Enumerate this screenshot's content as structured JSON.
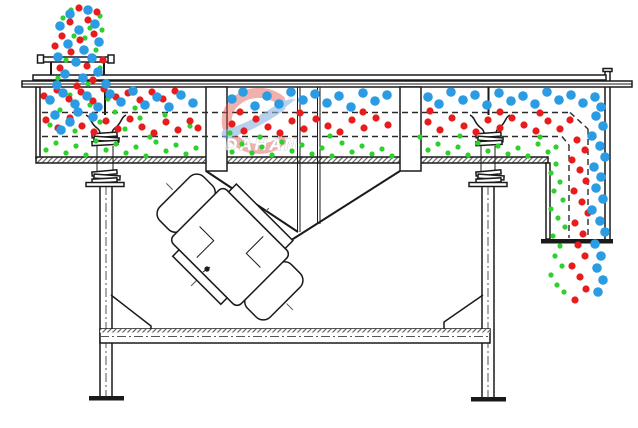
{
  "watermark": {
    "text": "DAHAN",
    "registered": "®",
    "logo_red": "#e2574b",
    "logo_blue": "#8cb4e2",
    "text_color": "#b5b5b5"
  },
  "colors": {
    "coarse_particle_blue": "#2b9be4",
    "medium_particle_red": "#e81c1c",
    "fine_particle_green": "#2ed02e",
    "line_black": "#1a1a1a",
    "background": "#ffffff"
  },
  "particles": {
    "blue": {
      "label": "coarse-particles",
      "color": "#2b9be4",
      "r": 4.8,
      "points": [
        [
          70,
          14
        ],
        [
          88,
          10
        ],
        [
          60,
          26
        ],
        [
          79,
          30
        ],
        [
          95,
          24
        ],
        [
          68,
          44
        ],
        [
          84,
          50
        ],
        [
          99,
          42
        ],
        [
          58,
          57
        ],
        [
          76,
          62
        ],
        [
          92,
          58
        ],
        [
          65,
          74
        ],
        [
          83,
          78
        ],
        [
          98,
          72
        ],
        [
          106,
          84
        ],
        [
          57,
          85
        ],
        [
          50,
          100
        ],
        [
          63,
          93
        ],
        [
          75,
          104
        ],
        [
          87,
          96
        ],
        [
          98,
          107
        ],
        [
          110,
          94
        ],
        [
          121,
          102
        ],
        [
          133,
          91
        ],
        [
          145,
          105
        ],
        [
          157,
          97
        ],
        [
          169,
          107
        ],
        [
          181,
          95
        ],
        [
          193,
          103
        ],
        [
          232,
          99
        ],
        [
          243,
          92
        ],
        [
          255,
          106
        ],
        [
          267,
          96
        ],
        [
          279,
          104
        ],
        [
          291,
          92
        ],
        [
          303,
          100
        ],
        [
          315,
          94
        ],
        [
          327,
          103
        ],
        [
          339,
          96
        ],
        [
          351,
          107
        ],
        [
          363,
          93
        ],
        [
          375,
          101
        ],
        [
          387,
          95
        ],
        [
          428,
          97
        ],
        [
          439,
          104
        ],
        [
          451,
          92
        ],
        [
          463,
          100
        ],
        [
          475,
          95
        ],
        [
          487,
          105
        ],
        [
          499,
          93
        ],
        [
          511,
          101
        ],
        [
          523,
          96
        ],
        [
          535,
          104
        ],
        [
          547,
          92
        ],
        [
          559,
          100
        ],
        [
          571,
          95
        ],
        [
          583,
          103
        ],
        [
          595,
          97
        ],
        [
          55,
          115
        ],
        [
          70,
          122
        ],
        [
          61,
          130
        ],
        [
          78,
          112
        ],
        [
          93,
          117
        ],
        [
          601,
          107
        ],
        [
          596,
          116
        ],
        [
          603,
          126
        ],
        [
          592,
          136
        ],
        [
          600,
          146
        ],
        [
          605,
          157
        ],
        [
          594,
          167
        ],
        [
          601,
          177
        ],
        [
          596,
          188
        ],
        [
          603,
          199
        ],
        [
          592,
          210
        ],
        [
          600,
          221
        ],
        [
          605,
          232
        ],
        [
          595,
          244
        ],
        [
          601,
          256
        ],
        [
          597,
          268
        ],
        [
          603,
          280
        ],
        [
          598,
          292
        ]
      ]
    },
    "red": {
      "label": "medium-particles",
      "color": "#e81c1c",
      "r": 3.6,
      "points": [
        [
          79,
          8
        ],
        [
          97,
          12
        ],
        [
          70,
          22
        ],
        [
          88,
          20
        ],
        [
          62,
          36
        ],
        [
          80,
          40
        ],
        [
          94,
          34
        ],
        [
          71,
          52
        ],
        [
          87,
          66
        ],
        [
          60,
          68
        ],
        [
          77,
          86
        ],
        [
          93,
          80
        ],
        [
          103,
          60
        ],
        [
          55,
          46
        ],
        [
          44,
          96
        ],
        [
          57,
          90
        ],
        [
          69,
          99
        ],
        [
          81,
          92
        ],
        [
          93,
          101
        ],
        [
          104,
          89
        ],
        [
          116,
          97
        ],
        [
          128,
          93
        ],
        [
          140,
          100
        ],
        [
          152,
          92
        ],
        [
          163,
          99
        ],
        [
          175,
          91
        ],
        [
          240,
          112
        ],
        [
          300,
          113
        ],
        [
          363,
          112
        ],
        [
          430,
          111
        ],
        [
          500,
          112
        ],
        [
          540,
          113
        ],
        [
          46,
          120
        ],
        [
          58,
          128
        ],
        [
          70,
          118
        ],
        [
          82,
          126
        ],
        [
          94,
          132
        ],
        [
          106,
          121
        ],
        [
          118,
          129
        ],
        [
          130,
          119
        ],
        [
          142,
          127
        ],
        [
          154,
          133
        ],
        [
          166,
          122
        ],
        [
          178,
          130
        ],
        [
          190,
          121
        ],
        [
          198,
          128
        ],
        [
          232,
          124
        ],
        [
          244,
          131
        ],
        [
          256,
          119
        ],
        [
          268,
          127
        ],
        [
          280,
          133
        ],
        [
          292,
          121
        ],
        [
          304,
          129
        ],
        [
          316,
          119
        ],
        [
          328,
          126
        ],
        [
          340,
          132
        ],
        [
          352,
          120
        ],
        [
          364,
          128
        ],
        [
          376,
          118
        ],
        [
          388,
          125
        ],
        [
          428,
          122
        ],
        [
          440,
          130
        ],
        [
          452,
          118
        ],
        [
          464,
          126
        ],
        [
          476,
          132
        ],
        [
          488,
          120
        ],
        [
          500,
          128
        ],
        [
          512,
          118
        ],
        [
          524,
          125
        ],
        [
          536,
          131
        ],
        [
          548,
          121
        ],
        [
          560,
          129
        ],
        [
          570,
          120
        ],
        [
          577,
          140
        ],
        [
          585,
          150
        ],
        [
          572,
          160
        ],
        [
          580,
          170
        ],
        [
          586,
          181
        ],
        [
          574,
          191
        ],
        [
          582,
          202
        ],
        [
          588,
          213
        ],
        [
          575,
          223
        ],
        [
          583,
          234
        ],
        [
          578,
          245
        ],
        [
          585,
          256
        ],
        [
          572,
          266
        ],
        [
          580,
          277
        ],
        [
          586,
          289
        ],
        [
          575,
          300
        ]
      ]
    },
    "green": {
      "label": "fine-particles",
      "color": "#2ed02e",
      "r": 2.6,
      "points": [
        [
          100,
          16
        ],
        [
          63,
          18
        ],
        [
          90,
          28
        ],
        [
          74,
          36
        ],
        [
          102,
          30
        ],
        [
          66,
          60
        ],
        [
          96,
          50
        ],
        [
          85,
          38
        ],
        [
          58,
          78
        ],
        [
          100,
          68
        ],
        [
          88,
          84
        ],
        [
          71,
          10
        ],
        [
          70,
          95
        ],
        [
          108,
          99
        ],
        [
          135,
          108
        ],
        [
          165,
          115
        ],
        [
          60,
          110
        ],
        [
          90,
          105
        ],
        [
          115,
          112
        ],
        [
          140,
          118
        ],
        [
          50,
          125
        ],
        [
          75,
          131
        ],
        [
          100,
          122
        ],
        [
          125,
          129
        ],
        [
          190,
          126
        ],
        [
          230,
          133
        ],
        [
          150,
          137
        ],
        [
          260,
          137
        ],
        [
          330,
          136
        ],
        [
          420,
          137
        ],
        [
          460,
          136
        ],
        [
          540,
          137
        ],
        [
          46,
          150
        ],
        [
          56,
          143
        ],
        [
          66,
          153
        ],
        [
          76,
          146
        ],
        [
          86,
          155
        ],
        [
          96,
          141
        ],
        [
          106,
          150
        ],
        [
          116,
          144
        ],
        [
          126,
          153
        ],
        [
          136,
          147
        ],
        [
          146,
          156
        ],
        [
          156,
          142
        ],
        [
          166,
          151
        ],
        [
          176,
          145
        ],
        [
          186,
          154
        ],
        [
          196,
          148
        ],
        [
          232,
          152
        ],
        [
          242,
          144
        ],
        [
          252,
          153
        ],
        [
          262,
          147
        ],
        [
          272,
          155
        ],
        [
          282,
          142
        ],
        [
          292,
          151
        ],
        [
          302,
          145
        ],
        [
          312,
          154
        ],
        [
          322,
          148
        ],
        [
          332,
          156
        ],
        [
          342,
          143
        ],
        [
          352,
          152
        ],
        [
          362,
          146
        ],
        [
          372,
          154
        ],
        [
          382,
          149
        ],
        [
          392,
          156
        ],
        [
          428,
          150
        ],
        [
          438,
          144
        ],
        [
          448,
          153
        ],
        [
          458,
          147
        ],
        [
          468,
          155
        ],
        [
          478,
          143
        ],
        [
          488,
          151
        ],
        [
          498,
          146
        ],
        [
          508,
          154
        ],
        [
          518,
          148
        ],
        [
          528,
          156
        ],
        [
          538,
          144
        ],
        [
          548,
          152
        ],
        [
          556,
          147
        ],
        [
          556,
          164
        ],
        [
          551,
          173
        ],
        [
          560,
          182
        ],
        [
          554,
          191
        ],
        [
          563,
          200
        ],
        [
          551,
          209
        ],
        [
          558,
          218
        ],
        [
          565,
          227
        ],
        [
          553,
          236
        ],
        [
          560,
          246
        ],
        [
          555,
          256
        ],
        [
          562,
          266
        ],
        [
          551,
          275
        ],
        [
          557,
          285
        ],
        [
          564,
          292
        ]
      ]
    }
  }
}
